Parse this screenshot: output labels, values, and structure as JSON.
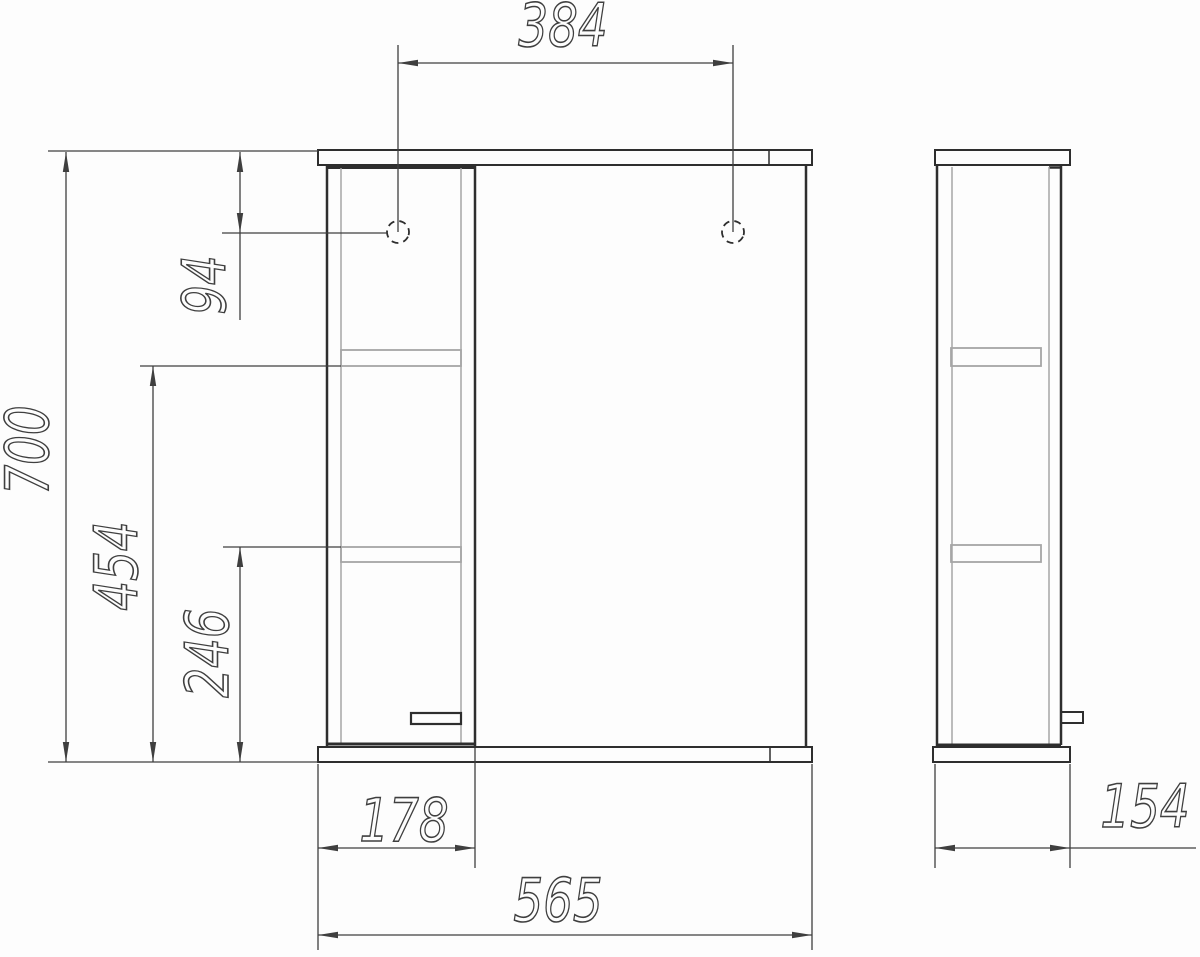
{
  "drawing": {
    "kind": "technical-dimension-drawing",
    "subject": "wall-mirror-cabinet",
    "colors": {
      "background": "#fdfdfd",
      "line_dark": "#2e2e2e",
      "line_light": "#a6a6a6",
      "dimension_line": "#3f3f3f",
      "text": "#3f3f3f"
    },
    "views": {
      "front": {
        "name": "front-view"
      },
      "side": {
        "name": "side-view"
      }
    },
    "dimensions": {
      "hole_spacing": {
        "value": "384",
        "orientation": "horizontal",
        "view": "front"
      },
      "overall_height": {
        "value": "700",
        "orientation": "vertical",
        "view": "front"
      },
      "hole_offset_top": {
        "value": "94",
        "orientation": "vertical",
        "view": "front"
      },
      "shelf1_from_bottom": {
        "value": "454",
        "orientation": "vertical",
        "view": "front"
      },
      "shelf2_from_bottom": {
        "value": "246",
        "orientation": "vertical",
        "view": "front"
      },
      "column_width": {
        "value": "178",
        "orientation": "horizontal",
        "view": "front"
      },
      "overall_width": {
        "value": "565",
        "orientation": "horizontal",
        "view": "front"
      },
      "overall_depth": {
        "value": "154",
        "orientation": "horizontal",
        "view": "side"
      }
    }
  }
}
